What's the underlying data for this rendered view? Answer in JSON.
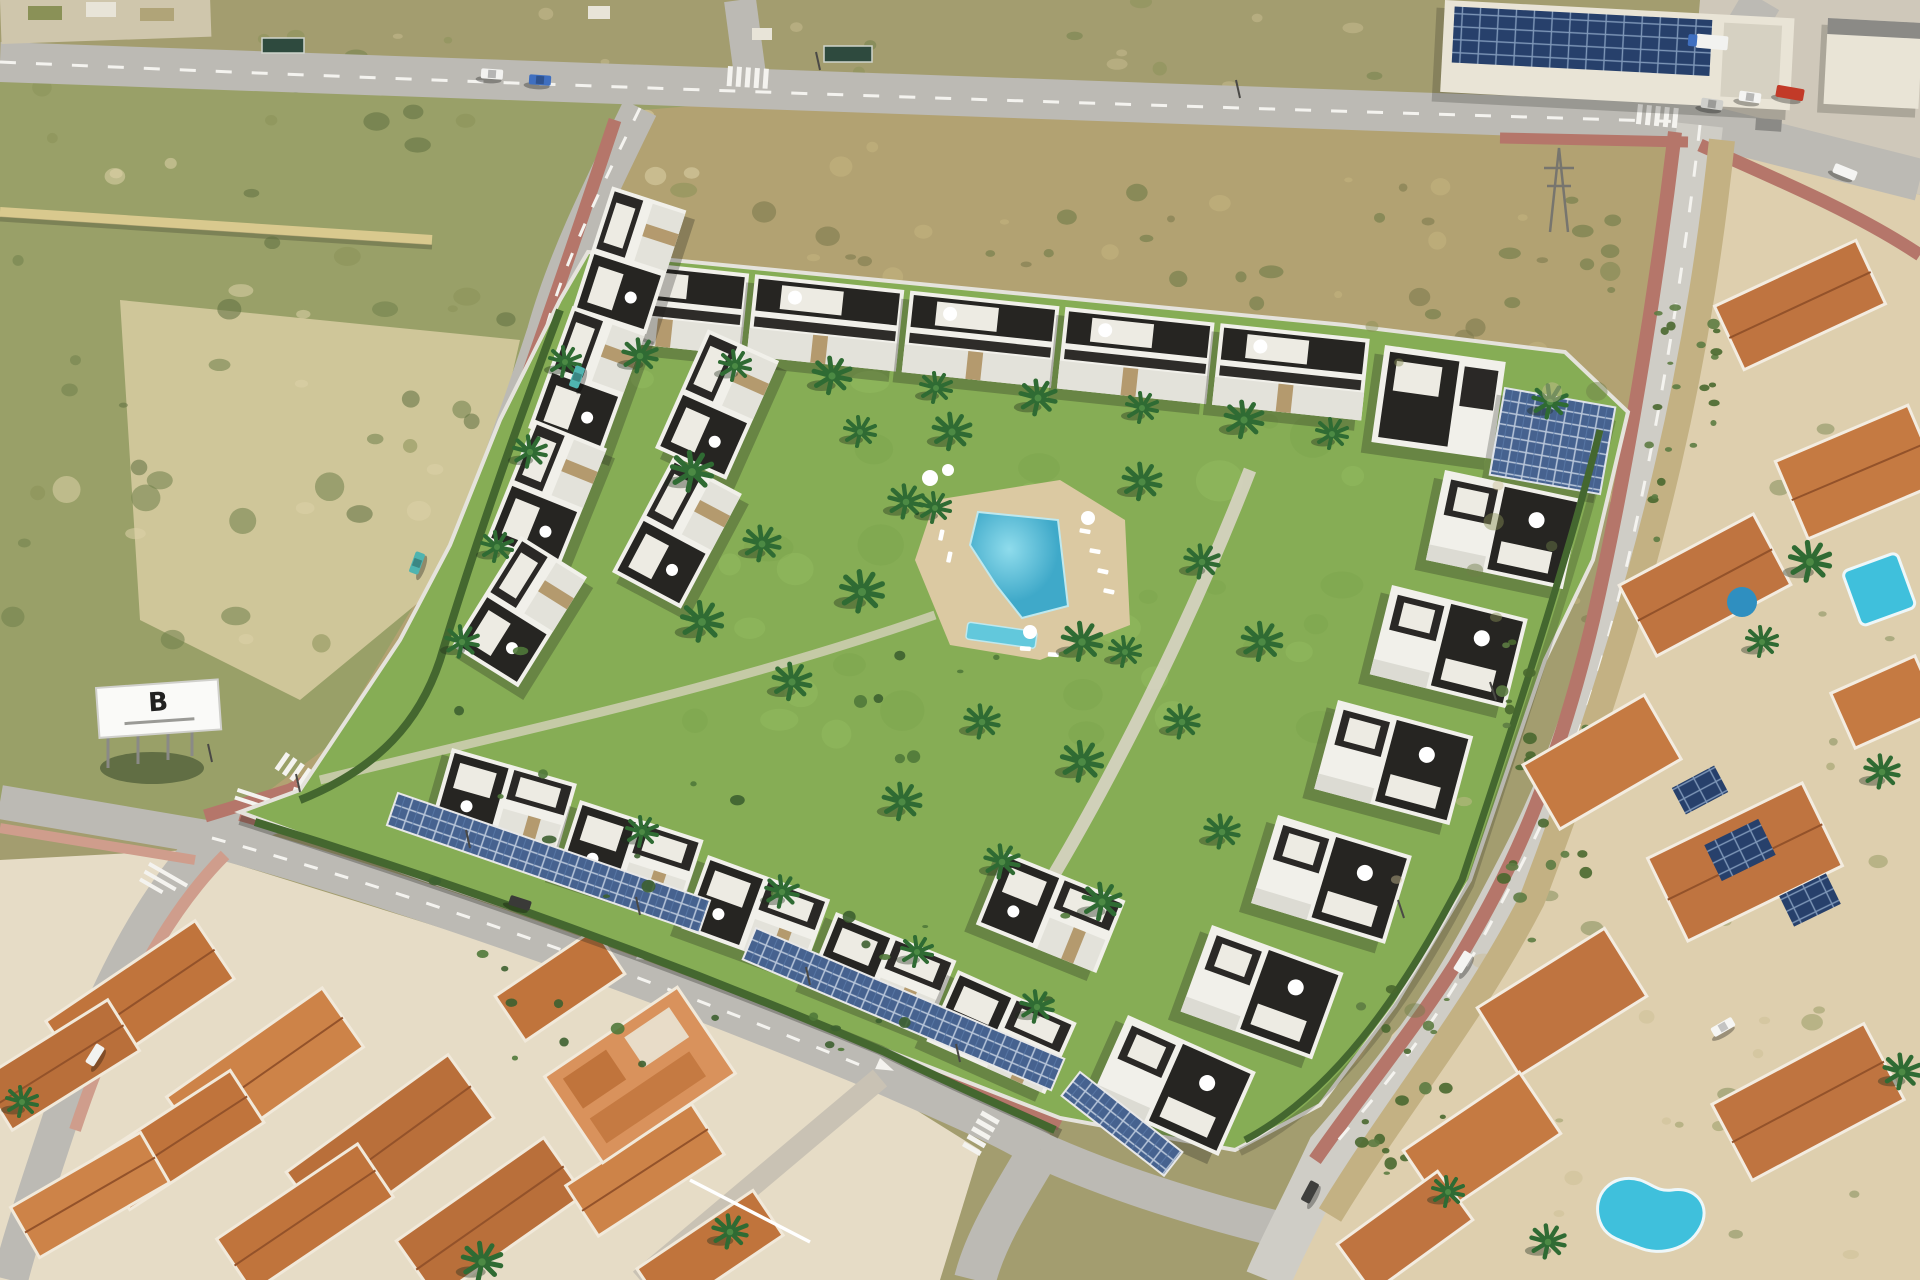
{
  "billboard": {
    "logo_text": "B"
  },
  "palette": {
    "scrub_base": "#a39d6f",
    "field_olive": "#99a068",
    "scrub_dark": "#6f7f4a",
    "sand": "#d8cda2",
    "sand_light": "#e4dab4",
    "hill_brown": "#b2a272",
    "hill_clump": "#7d7a4e",
    "road": "#bcbab4",
    "road_light": "#cfcdc6",
    "marking": "#f4f3ef",
    "sidewalk_red": "#b5766a",
    "sidewalk_pink": "#cf9d8c",
    "lawn": "#86ad55",
    "lawn_light": "#95bd62",
    "hedge": "#44672f",
    "shrub": "#50793a",
    "palm_green": "#2f6b33",
    "deck": "#dbc9a2",
    "pool": "#4cbcd6",
    "pool_light": "#8fdcec",
    "kids_pool": "#62c8dc",
    "building_white": "#f1f0ea",
    "building_shade": "#e3e2da",
    "building_dark": "#262522",
    "stone": "#b49a6e",
    "solar_blue": "#46628f",
    "solar_dark": "#27406b",
    "roof_terracotta": "#bf7440",
    "roof_ridge": "#93522a",
    "town_wall": "#e6dcc6",
    "town_orange": "#d9925c",
    "villas_base": "#decfae",
    "channel": "#c3b183",
    "villa_pool_aqua": "#3fc0dc",
    "industrial_wall": "#e9e4d6",
    "apron": "#cfc8ba",
    "car_red": "#c23a28",
    "car_blue": "#3f6fc0",
    "car_teal": "#4fb4b0",
    "billboard_white": "#fafaf8",
    "billboard_text": "#222222"
  }
}
